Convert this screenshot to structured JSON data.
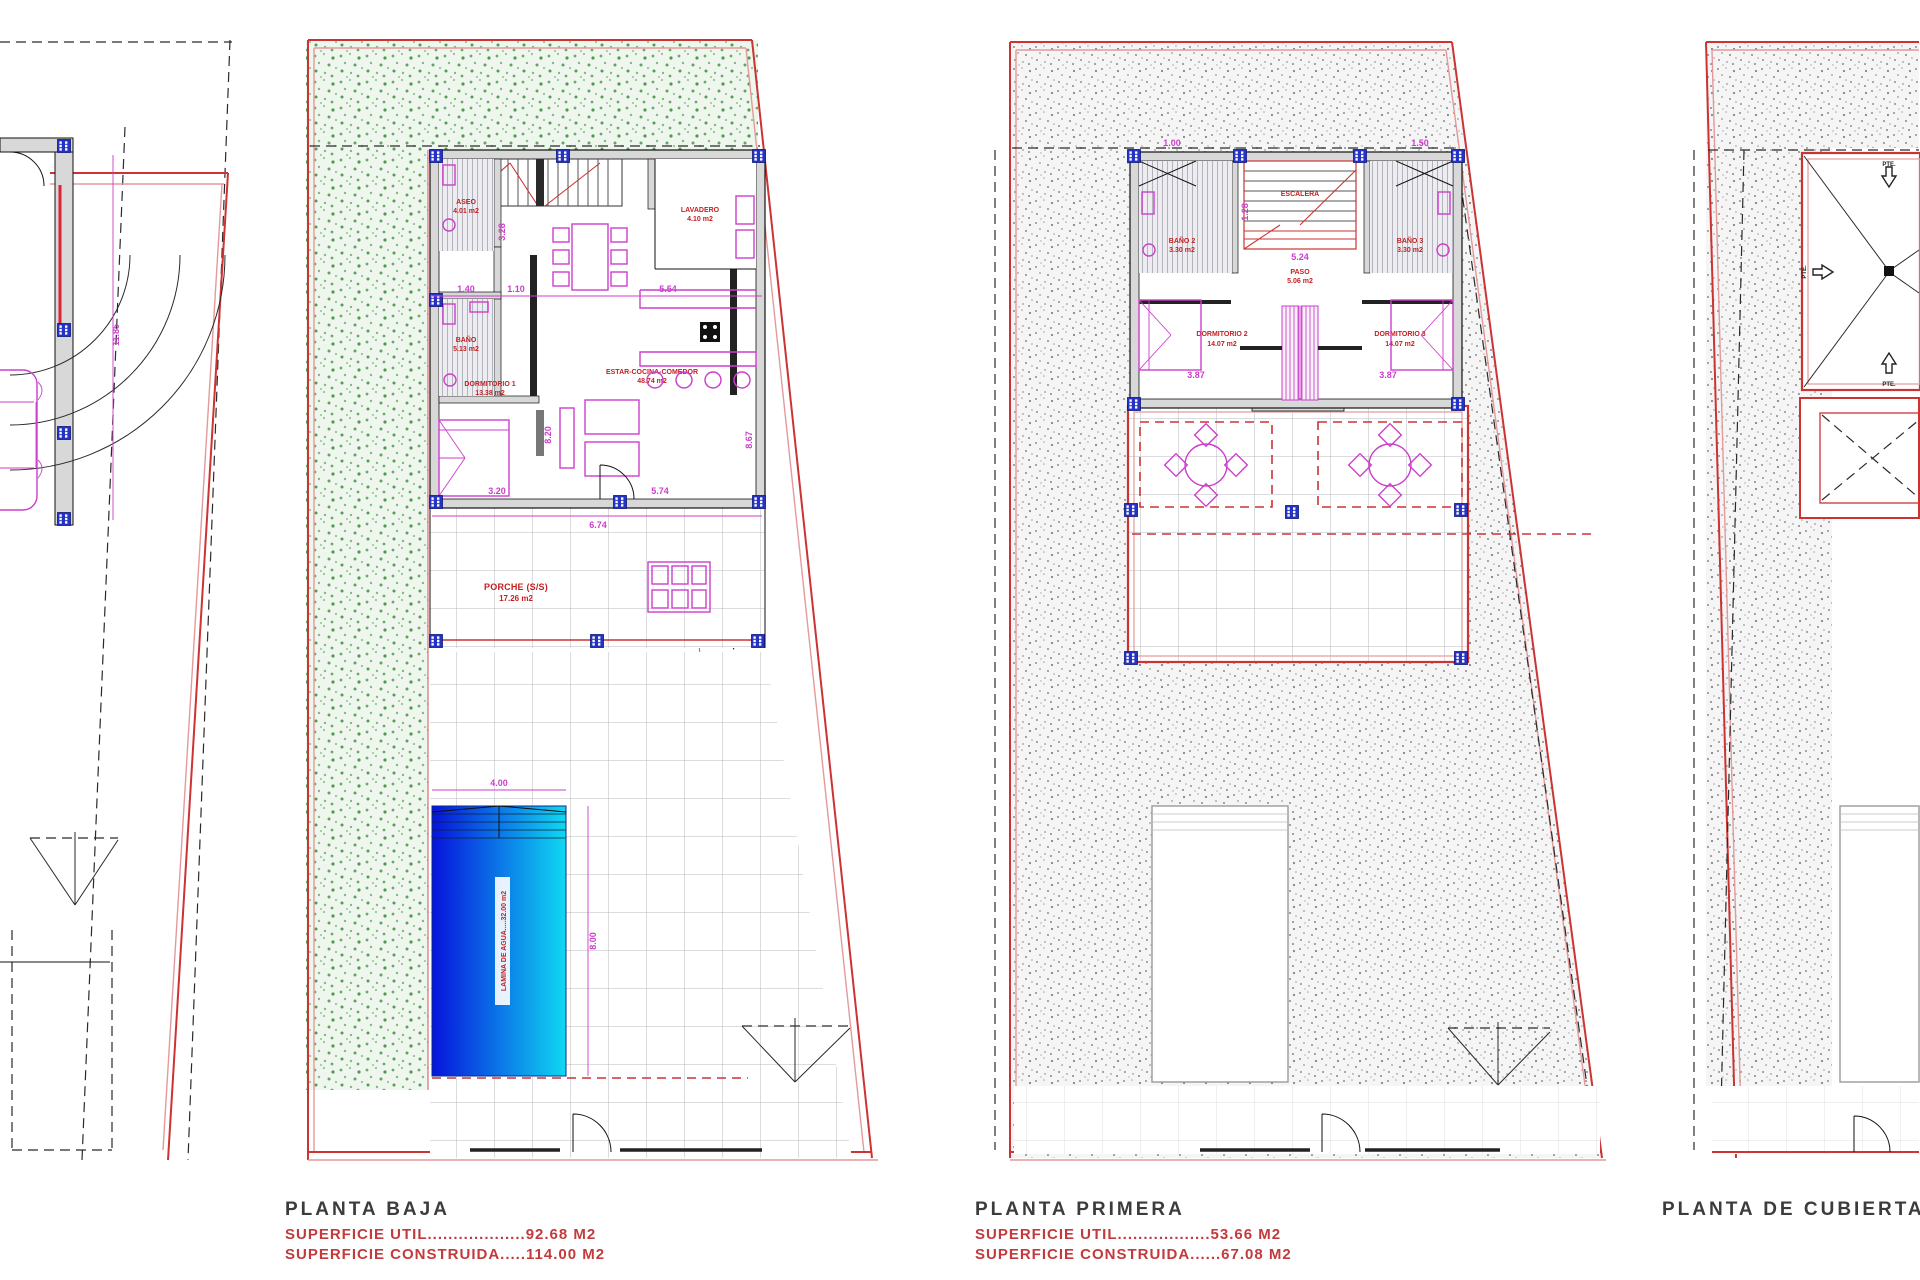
{
  "panels": {
    "site": {
      "dim_height": "11.85"
    },
    "planta_baja": {
      "title": "PLANTA BAJA",
      "superficie_util": "SUPERFICIE UTIL...................92.68 M2",
      "superficie_construida": "SUPERFICIE CONSTRUIDA.....114.00 M2",
      "rooms": {
        "aseo": {
          "name": "ASEO",
          "area": "4.01 m2"
        },
        "lavadero": {
          "name": "LAVADERO",
          "area": "4.10 m2"
        },
        "bano": {
          "name": "BAÑO",
          "area": "5.13 m2"
        },
        "dormitorio1": {
          "name": "DORMITORIO 1",
          "area": "13.38 m2"
        },
        "salon": {
          "name": "ESTAR-COCINA-COMEDOR",
          "area": "48.74 m2"
        },
        "porche": {
          "name": "PORCHE (S/S)",
          "area": "17.26 m2"
        }
      },
      "pool": {
        "label": "LAMINA DE AGUA.....32.00 m2",
        "width": "4.00",
        "height": "8.00"
      },
      "dims": {
        "w_dorm1": "3.20",
        "w_salon": "5.74",
        "w_porche": "6.74",
        "h_salon": "8.20",
        "h_right": "8.67",
        "c_140": "1.40",
        "c_110": "1.10",
        "c_554": "5.54",
        "v_328": "3.28"
      }
    },
    "planta_primera": {
      "title": "PLANTA PRIMERA",
      "superficie_util": "SUPERFICIE UTIL..................53.66 M2",
      "superficie_construida": "SUPERFICIE CONSTRUIDA......67.08 M2",
      "rooms": {
        "bano2": {
          "name": "BAÑO 2",
          "area": "3.30 m2"
        },
        "bano3": {
          "name": "BAÑO 3",
          "area": "3.30 m2"
        },
        "paso": {
          "name": "PASO",
          "area": "5.06 m2"
        },
        "escalera": {
          "name": "ESCALERA"
        },
        "dormitorio2": {
          "name": "DORMITORIO 2",
          "area": "14.07 m2"
        },
        "dormitorio3": {
          "name": "DORMITORIO 3",
          "area": "14.07 m2"
        }
      },
      "dims": {
        "c_524": "5.24",
        "w_dorm2": "3.87",
        "w_dorm3": "3.87",
        "v_128": "1.28",
        "c_100": "1.00",
        "c_150": "1.50"
      }
    },
    "cubierta": {
      "title": "PLANTA DE CUBIERTA",
      "slope": "PTE."
    }
  }
}
